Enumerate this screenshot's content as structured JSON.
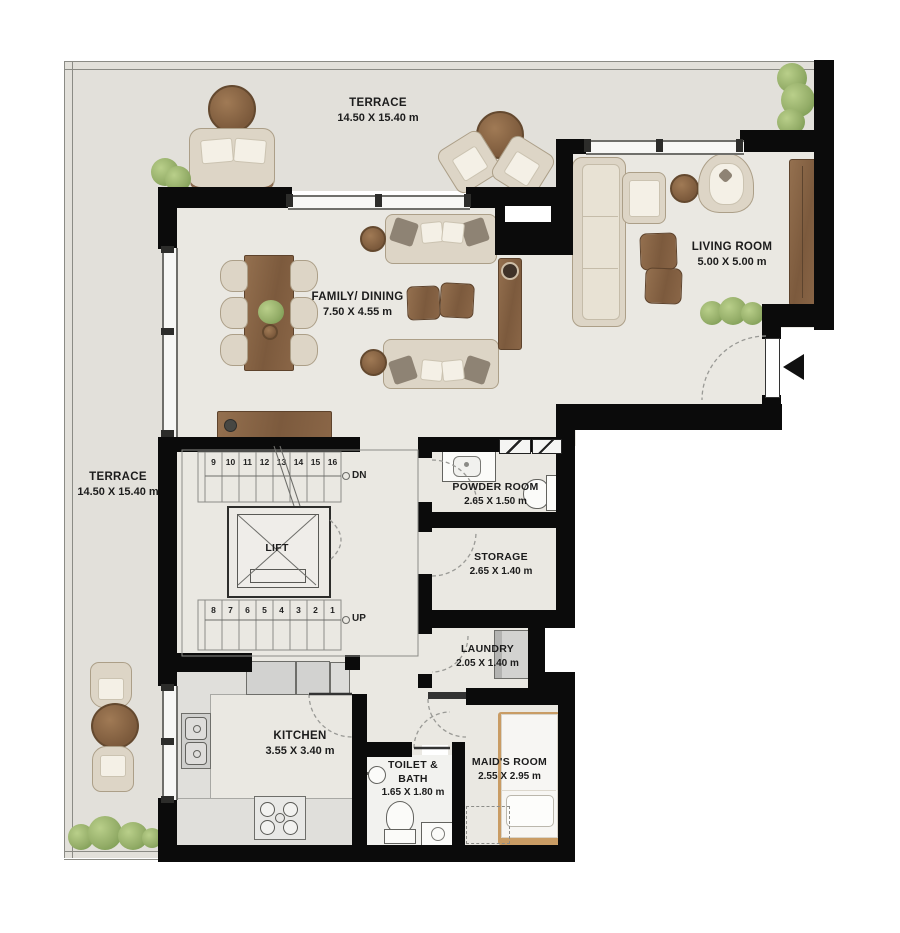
{
  "plan": {
    "rooms": {
      "terrace_top": {
        "name": "TERRACE",
        "dims": "14.50 X 15.40 m"
      },
      "terrace_left": {
        "name": "TERRACE",
        "dims": "14.50 X 15.40 m"
      },
      "living": {
        "name": "LIVING ROOM",
        "dims": "5.00 X 5.00 m"
      },
      "family": {
        "name": "FAMILY/ DINING",
        "dims": "7.50 X 4.55 m"
      },
      "powder": {
        "name": "POWDER ROOM",
        "dims": "2.65 X 1.50 m"
      },
      "storage": {
        "name": "STORAGE",
        "dims": "2.65 X 1.40 m"
      },
      "laundry": {
        "name": "LAUNDRY",
        "dims": "2.05 X 1.40 m"
      },
      "kitchen": {
        "name": "KITCHEN",
        "dims": "3.55 X 3.40 m"
      },
      "toilet": {
        "name": "TOILET & BATH",
        "dims": "1.65 X 1.80 m"
      },
      "maid": {
        "name": "MAID'S ROOM",
        "dims": "2.55 X 2.95 m"
      }
    },
    "lift_label": "LIFT",
    "stairs": {
      "down_label": "DN",
      "up_label": "UP",
      "upper_steps": [
        "9",
        "10",
        "11",
        "12",
        "13",
        "14",
        "15",
        "16"
      ],
      "lower_steps": [
        "8",
        "7",
        "6",
        "5",
        "4",
        "3",
        "2",
        "1"
      ]
    },
    "colors": {
      "wall": "#0b0b0b",
      "terrace_floor": "#e2e0da",
      "interior_floor": "#eae8e2",
      "bath_floor": "#f2f2ef",
      "wood": "#84624a",
      "upholstery": "#ddd5c6",
      "appliance": "#d2d2d0",
      "plant_green": "#94ad68",
      "text": "#1c1c1c"
    }
  }
}
